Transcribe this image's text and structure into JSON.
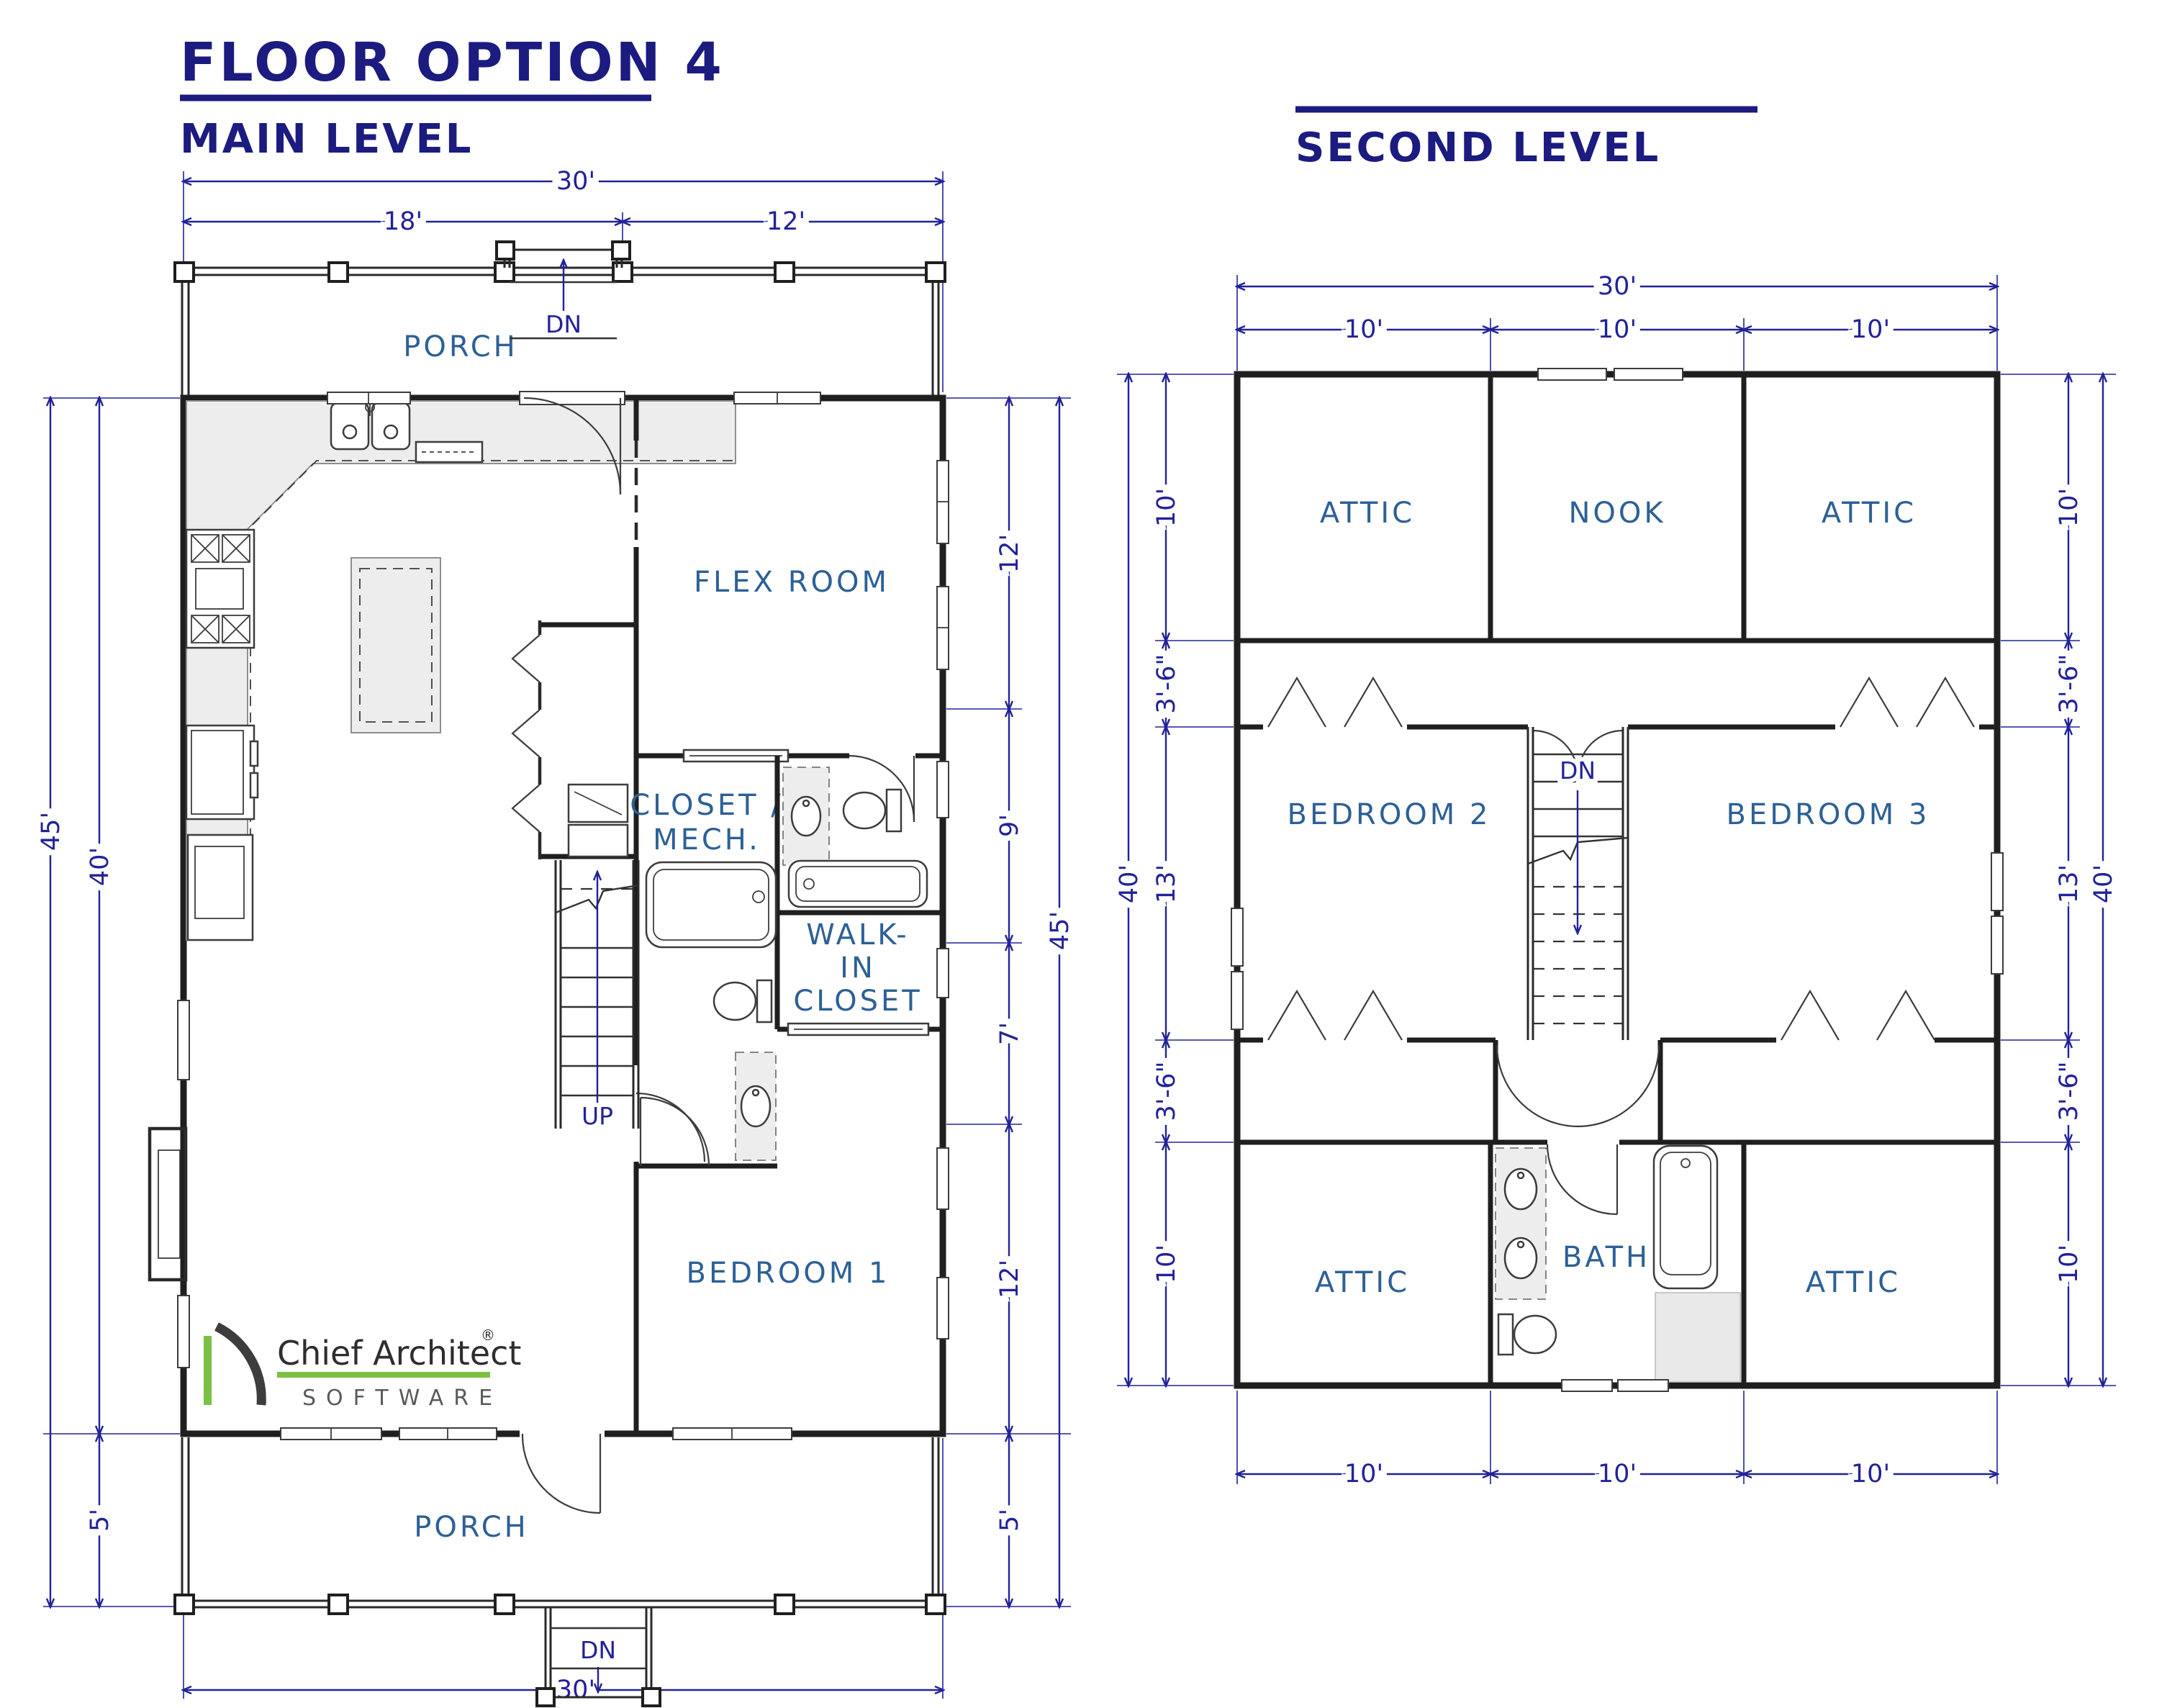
{
  "header": {
    "title": "FLOOR OPTION 4",
    "main_level_label": "MAIN LEVEL",
    "second_level_label": "SECOND LEVEL"
  },
  "rooms": {
    "porch_top": "PORCH",
    "porch_bottom": "PORCH",
    "flex_room": "FLEX ROOM",
    "closet_mech_line1": "CLOSET /",
    "closet_mech_line2": "MECH.",
    "walk_in_line1": "WALK-",
    "walk_in_line2": "IN",
    "walk_in_line3": "CLOSET",
    "bedroom1": "BEDROOM 1",
    "bedroom2": "BEDROOM 2",
    "bedroom3": "BEDROOM 3",
    "attic_top_left": "ATTIC",
    "attic_top_right": "ATTIC",
    "attic_bottom_left": "ATTIC",
    "attic_bottom_right": "ATTIC",
    "nook": "NOOK",
    "bath": "BATH"
  },
  "stairs": {
    "main_up": "UP",
    "main_entry_dn": "DN",
    "main_porch_dn": "DN",
    "second_dn": "DN"
  },
  "main_level_dims": {
    "overall_top": "30'",
    "top_left": "18'",
    "top_right": "12'",
    "bottom": "30'",
    "left_outer": "45'",
    "left_house": "40'",
    "left_porch": "5'",
    "right_outer": "45'",
    "right_seg1": "12'",
    "right_seg2": "9'",
    "right_seg3": "7'",
    "right_seg4": "12'",
    "right_porch": "5'"
  },
  "second_level_dims": {
    "overall_top": "30'",
    "top_seg1": "10'",
    "top_seg2": "10'",
    "top_seg3": "10'",
    "bottom_seg1": "10'",
    "bottom_seg2": "10'",
    "bottom_seg3": "10'",
    "left_outer": "40'",
    "left_seg1": "10'",
    "left_seg2": "3'-6\"",
    "left_seg3": "13'",
    "left_seg4": "3'-6\"",
    "left_seg5": "10'",
    "right_outer": "40'",
    "right_seg1": "10'",
    "right_seg2": "3'-6\"",
    "right_seg3": "13'",
    "right_seg4": "3'-6\"",
    "right_seg5": "10'"
  },
  "logo": {
    "brand": "Chief Architect",
    "registered": "®",
    "subtitle": "SOFTWARE"
  },
  "colors": {
    "dimension_blue": "#22229a",
    "room_label_blue": "#2d6096",
    "title_navy": "#1b1b80",
    "wall_black": "#1f1f1f",
    "counter_gray": "#ededed",
    "logo_green": "#7ac143",
    "logo_gray": "#3d3d3d"
  }
}
